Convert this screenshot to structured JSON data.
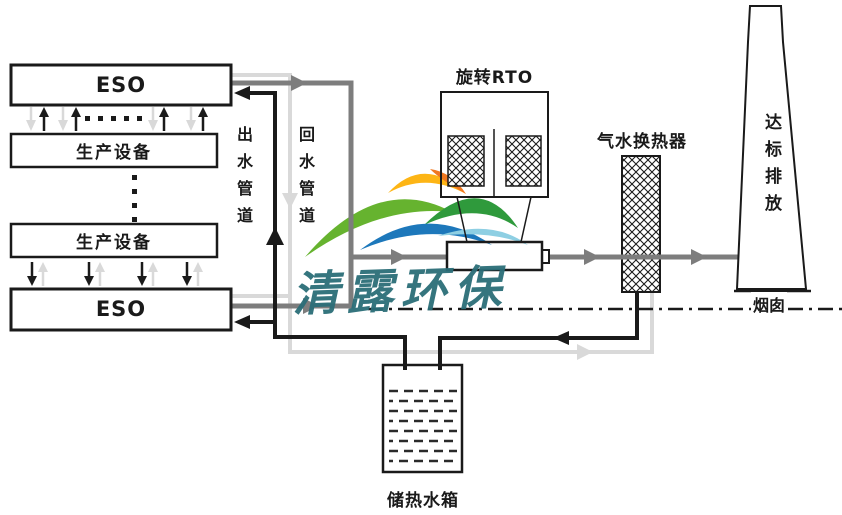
{
  "diagram": {
    "eso_top_label": "ESO",
    "production_unit_label_1": "生产设备",
    "production_unit_label_2": "生产设备",
    "eso_bottom_label": "ESO",
    "outlet_pipe_label": "出水管道",
    "return_pipe_label": "回水管道",
    "rto_label": "旋转RTO",
    "heat_exchanger_label": "气水换热器",
    "stack_discharge_label": "达标排放",
    "chimney_label": "烟囱",
    "tank_label": "储热水箱"
  },
  "watermark": {
    "text": "清露环保"
  },
  "colors": {
    "line_black": "#1a1a1a",
    "gas_pipe_gray": "#7d7d7d",
    "return_pipe_light": "#d9d9d9",
    "watermark_teal": "#2b6e78",
    "logo_yellow": "#fdb515",
    "logo_orange": "#f07820",
    "logo_green_light": "#66b32f",
    "logo_green_dark": "#2f9a3c",
    "logo_blue": "#1d78bb",
    "logo_cyan": "#8ecfe3"
  }
}
